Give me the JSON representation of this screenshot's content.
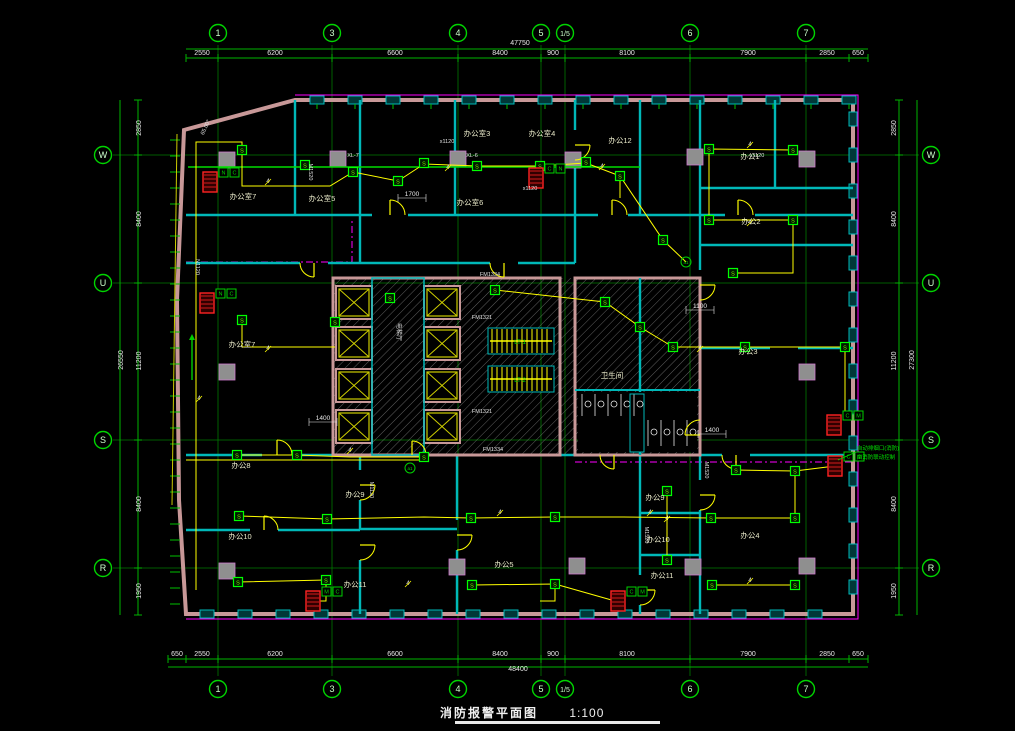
{
  "title": {
    "text": "消防报警平面图",
    "scale": "1:100"
  },
  "colors": {
    "bg": "#000000",
    "gridline": "#007a00",
    "dimline": "#00b400",
    "bubble": "#00d400",
    "bubble_text": "#ccffcc",
    "dim_text": "#e8e8e8",
    "wall_outer": "#c89898",
    "wall_inner": "#00b8b8",
    "wire": "#ffff00",
    "bus": "#00dd00",
    "detector": "#00ff00",
    "hydrant": "#ff2222",
    "magenta": "#ff00ff",
    "column": "#8f8f8f",
    "column_stroke": "#cc77cc",
    "hatch": "#8a8a8a",
    "room_label": "#e8e8c8",
    "code_label": "#e0e0e0",
    "note": "#00e000",
    "stair": "#ffff00"
  },
  "grid": {
    "cols": [
      {
        "label": "1",
        "x": 218
      },
      {
        "label": "3",
        "x": 332
      },
      {
        "label": "4",
        "x": 458
      },
      {
        "label": "5",
        "x": 541
      },
      {
        "label": "1/5",
        "x": 565
      },
      {
        "label": "6",
        "x": 690
      },
      {
        "label": "7",
        "x": 806
      }
    ],
    "rows": [
      {
        "label": "W",
        "y": 155
      },
      {
        "label": "U",
        "y": 283
      },
      {
        "label": "S",
        "y": 440
      },
      {
        "label": "R",
        "y": 568
      }
    ],
    "top_bubble_y": 33,
    "bottom_bubble_y": 689,
    "left_bubble_x": 103,
    "right_bubble_x": 931
  },
  "dims": {
    "top": {
      "total": "47750",
      "total_x": 520,
      "total_y": 45,
      "total_line_y": 49,
      "line_y": 58,
      "x0": 186,
      "x1": 868,
      "ticks": [
        186,
        218,
        332,
        458,
        541,
        565,
        690,
        806,
        849,
        868
      ],
      "values": [
        {
          "v": "2550",
          "x": 202
        },
        {
          "v": "6200",
          "x": 275
        },
        {
          "v": "6600",
          "x": 395
        },
        {
          "v": "8400",
          "x": 500
        },
        {
          "v": "900",
          "x": 553
        },
        {
          "v": "8100",
          "x": 627
        },
        {
          "v": "7900",
          "x": 748
        },
        {
          "v": "2850",
          "x": 827
        },
        {
          "v": "650",
          "x": 858
        }
      ]
    },
    "bottom": {
      "total": "48400",
      "total_x": 518,
      "total_y": 671,
      "total_line_y": 667,
      "line_y": 659,
      "x0": 168,
      "x1": 868,
      "ticks": [
        168,
        186,
        218,
        332,
        458,
        541,
        565,
        690,
        806,
        849,
        868
      ],
      "values": [
        {
          "v": "650",
          "x": 177
        },
        {
          "v": "2550",
          "x": 202
        },
        {
          "v": "6200",
          "x": 275
        },
        {
          "v": "6600",
          "x": 395
        },
        {
          "v": "8400",
          "x": 500
        },
        {
          "v": "900",
          "x": 553
        },
        {
          "v": "8100",
          "x": 627
        },
        {
          "v": "7900",
          "x": 748
        },
        {
          "v": "2850",
          "x": 827
        },
        {
          "v": "650",
          "x": 858
        }
      ]
    },
    "left": {
      "line_x": 138,
      "outer_x": 120,
      "total": "26550",
      "total_y": 360,
      "ticks": [
        100,
        155,
        283,
        440,
        568,
        615
      ],
      "values": [
        {
          "v": "2850",
          "y": 128
        },
        {
          "v": "8400",
          "y": 219
        },
        {
          "v": "11200",
          "y": 361
        },
        {
          "v": "8400",
          "y": 504
        },
        {
          "v": "1950",
          "y": 591
        }
      ]
    },
    "right": {
      "line_x": 899,
      "outer_x": 917,
      "total": "27300",
      "total_y": 360,
      "ticks": [
        100,
        155,
        283,
        440,
        568,
        615
      ],
      "values": [
        {
          "v": "2850",
          "y": 128
        },
        {
          "v": "8400",
          "y": 219
        },
        {
          "v": "11200",
          "y": 361
        },
        {
          "v": "8400",
          "y": 504
        },
        {
          "v": "1950",
          "y": 591
        }
      ]
    }
  },
  "rooms": [
    {
      "label": "办公室7",
      "x": 243,
      "y": 199
    },
    {
      "label": "办公室5",
      "x": 322,
      "y": 201
    },
    {
      "label": "办公室3",
      "x": 477,
      "y": 136
    },
    {
      "label": "办公室4",
      "x": 542,
      "y": 136
    },
    {
      "label": "办公12",
      "x": 620,
      "y": 143
    },
    {
      "label": "办公室6",
      "x": 470,
      "y": 205
    },
    {
      "label": "办公1",
      "x": 750,
      "y": 159
    },
    {
      "label": "办公2",
      "x": 751,
      "y": 224
    },
    {
      "label": "办公室7",
      "x": 242,
      "y": 347
    },
    {
      "label": "办公3",
      "x": 748,
      "y": 354
    },
    {
      "label": "办公8",
      "x": 241,
      "y": 468
    },
    {
      "label": "办公10",
      "x": 240,
      "y": 539
    },
    {
      "label": "办公9",
      "x": 355,
      "y": 497
    },
    {
      "label": "办公11",
      "x": 355,
      "y": 587
    },
    {
      "label": "办公5",
      "x": 504,
      "y": 567
    },
    {
      "label": "办公9",
      "x": 655,
      "y": 500
    },
    {
      "label": "办公10",
      "x": 658,
      "y": 542
    },
    {
      "label": "办公11",
      "x": 662,
      "y": 578
    },
    {
      "label": "办公4",
      "x": 750,
      "y": 538
    },
    {
      "label": "卫生间",
      "x": 612,
      "y": 378
    }
  ],
  "core_label": {
    "text": "电梯厅",
    "x": 397,
    "y": 332
  },
  "stair_labels": [
    {
      "text": "LT-1",
      "x": 520,
      "y": 344
    },
    {
      "text": "LT-2",
      "x": 520,
      "y": 382
    }
  ],
  "codes": [
    {
      "text": "XL-7",
      "x": 353,
      "y": 157,
      "rot": 0
    },
    {
      "text": "XL-6",
      "x": 472,
      "y": 157,
      "rot": 0
    },
    {
      "text": "FM1334",
      "x": 490,
      "y": 276,
      "rot": 0
    },
    {
      "text": "FM1321",
      "x": 482,
      "y": 319,
      "rot": 0
    },
    {
      "text": "FM1321",
      "x": 482,
      "y": 413,
      "rot": 0
    },
    {
      "text": "FM1334",
      "x": 493,
      "y": 451,
      "rot": 0
    },
    {
      "text": "M1520",
      "x": 309,
      "y": 172,
      "rot": 90
    },
    {
      "text": "x1120",
      "x": 447,
      "y": 143,
      "rot": 0
    },
    {
      "text": "x1120",
      "x": 530,
      "y": 190,
      "rot": 0
    },
    {
      "text": "x1120",
      "x": 757,
      "y": 157,
      "rot": 0
    },
    {
      "text": "N1120",
      "x": 196,
      "y": 267,
      "rot": 90
    },
    {
      "text": "M1120",
      "x": 370,
      "y": 490,
      "rot": 90
    },
    {
      "text": "M1520",
      "x": 645,
      "y": 535,
      "rot": 90
    },
    {
      "text": "M1520",
      "x": 705,
      "y": 470,
      "rot": 90
    },
    {
      "text": "65.00°",
      "x": 207,
      "y": 128,
      "rot": -65
    }
  ],
  "inner_dims": [
    {
      "v": "1700",
      "x": 412,
      "y": 196
    },
    {
      "v": "1100",
      "x": 700,
      "y": 308
    },
    {
      "v": "1400",
      "x": 323,
      "y": 420
    },
    {
      "v": "1400",
      "x": 712,
      "y": 432
    }
  ],
  "notes": [
    {
      "text": "自动排烟口(消防)",
      "x": 878,
      "y": 450
    },
    {
      "text": "由消防联动控制",
      "x": 876,
      "y": 459
    }
  ],
  "detectors": [
    [
      242,
      150
    ],
    [
      305,
      165
    ],
    [
      353,
      172
    ],
    [
      398,
      181
    ],
    [
      424,
      163
    ],
    [
      477,
      166
    ],
    [
      540,
      166
    ],
    [
      586,
      162
    ],
    [
      620,
      176
    ],
    [
      663,
      240
    ],
    [
      709,
      149
    ],
    [
      793,
      150
    ],
    [
      709,
      220
    ],
    [
      793,
      220
    ],
    [
      733,
      273
    ],
    [
      242,
      320
    ],
    [
      335,
      322
    ],
    [
      390,
      298
    ],
    [
      495,
      290
    ],
    [
      605,
      302
    ],
    [
      640,
      327
    ],
    [
      673,
      347
    ],
    [
      745,
      347
    ],
    [
      845,
      347
    ],
    [
      237,
      455
    ],
    [
      297,
      455
    ],
    [
      424,
      457
    ],
    [
      239,
      516
    ],
    [
      327,
      519
    ],
    [
      471,
      518
    ],
    [
      555,
      517
    ],
    [
      711,
      518
    ],
    [
      795,
      518
    ],
    [
      238,
      582
    ],
    [
      326,
      580
    ],
    [
      472,
      585
    ],
    [
      555,
      584
    ],
    [
      712,
      585
    ],
    [
      795,
      585
    ],
    [
      736,
      470
    ],
    [
      795,
      471
    ],
    [
      667,
      491
    ],
    [
      667,
      560
    ]
  ],
  "detector_symbol": "S",
  "circle_tags": [
    {
      "text": "a1",
      "x": 410,
      "y": 468
    },
    {
      "text": "a1",
      "x": 686,
      "y": 262
    }
  ],
  "hydrants": [
    {
      "x": 210,
      "y": 182,
      "tag": "N C"
    },
    {
      "x": 207,
      "y": 303,
      "tag": "N C"
    },
    {
      "x": 536,
      "y": 178,
      "tag": "C N"
    },
    {
      "x": 313,
      "y": 601,
      "tag": "M C"
    },
    {
      "x": 618,
      "y": 601,
      "tag": "C M"
    },
    {
      "x": 834,
      "y": 425,
      "tag": "C M"
    },
    {
      "x": 835,
      "y": 466,
      "tag": "C M"
    }
  ],
  "wire_tags": [
    "4",
    "4",
    "4",
    "4",
    "4",
    "4",
    "4",
    "4",
    "4",
    "4",
    "4",
    "4",
    "4",
    "4"
  ],
  "wire_tag_pos": [
    [
      268,
      183
    ],
    [
      448,
      169
    ],
    [
      602,
      168
    ],
    [
      750,
      146
    ],
    [
      750,
      224
    ],
    [
      268,
      350
    ],
    [
      700,
      350
    ],
    [
      350,
      452
    ],
    [
      500,
      514
    ],
    [
      650,
      514
    ],
    [
      750,
      582
    ],
    [
      408,
      585
    ],
    [
      199,
      400
    ],
    [
      667,
      520
    ]
  ],
  "columns": [
    [
      227,
      160
    ],
    [
      338,
      159
    ],
    [
      458,
      159
    ],
    [
      573,
      160
    ],
    [
      695,
      157
    ],
    [
      807,
      159
    ],
    [
      227,
      372
    ],
    [
      807,
      372
    ],
    [
      227,
      571
    ],
    [
      457,
      567
    ],
    [
      577,
      566
    ],
    [
      693,
      567
    ],
    [
      807,
      566
    ]
  ],
  "walls": {
    "outer": [
      [
        295,
        100
      ],
      [
        853,
        100
      ],
      [
        853,
        614
      ],
      [
        186,
        614
      ],
      [
        179,
        500
      ],
      [
        177,
        300
      ],
      [
        184,
        130
      ]
    ],
    "inner_h": [
      [
        186,
        215,
        372,
        215
      ],
      [
        408,
        215,
        598,
        215
      ],
      [
        628,
        215,
        725,
        215
      ],
      [
        755,
        215,
        853,
        215
      ],
      [
        186,
        263,
        300,
        263
      ],
      [
        328,
        263,
        490,
        263
      ],
      [
        518,
        263,
        575,
        263
      ],
      [
        700,
        188,
        853,
        188
      ],
      [
        700,
        245,
        853,
        245
      ],
      [
        700,
        348,
        770,
        348
      ],
      [
        798,
        348,
        853,
        348
      ],
      [
        186,
        455,
        262,
        455
      ],
      [
        292,
        455,
        333,
        455
      ],
      [
        426,
        455,
        575,
        455
      ],
      [
        628,
        455,
        722,
        455
      ],
      [
        750,
        455,
        853,
        455
      ],
      [
        186,
        530,
        250,
        530
      ],
      [
        278,
        530,
        360,
        530
      ],
      [
        640,
        513,
        700,
        513
      ],
      [
        640,
        555,
        700,
        555
      ],
      [
        360,
        529,
        457,
        529
      ]
    ],
    "inner_v": [
      [
        295,
        100,
        295,
        215
      ],
      [
        360,
        100,
        360,
        263
      ],
      [
        455,
        100,
        455,
        215
      ],
      [
        575,
        100,
        575,
        130
      ],
      [
        575,
        160,
        575,
        263
      ],
      [
        640,
        100,
        640,
        215
      ],
      [
        775,
        100,
        775,
        188
      ],
      [
        700,
        100,
        700,
        270
      ],
      [
        700,
        300,
        700,
        420
      ],
      [
        700,
        450,
        700,
        455
      ],
      [
        360,
        455,
        360,
        470
      ],
      [
        360,
        500,
        360,
        530
      ],
      [
        360,
        560,
        360,
        614
      ],
      [
        457,
        455,
        457,
        520
      ],
      [
        457,
        550,
        457,
        614
      ],
      [
        640,
        455,
        640,
        575
      ],
      [
        640,
        605,
        640,
        614
      ],
      [
        700,
        455,
        700,
        480
      ],
      [
        700,
        510,
        700,
        614
      ]
    ]
  },
  "core": {
    "band": [
      333,
      278,
      367,
      177
    ],
    "outer": [
      333,
      278,
      227,
      177
    ],
    "shaft_w": 36,
    "shaft_h": 33,
    "shaft_cols": [
      336,
      424
    ],
    "shaft_rows": [
      286,
      327,
      369,
      410
    ],
    "lobby": [
      372,
      278,
      52,
      177
    ],
    "stairs": [
      {
        "x": 488,
        "y": 328,
        "w": 66,
        "h": 26
      },
      {
        "x": 488,
        "y": 366,
        "w": 66,
        "h": 26
      }
    ],
    "wash": [
      575,
      278,
      125,
      177
    ],
    "wash_split_x": 640,
    "toilet_y": 390
  },
  "wires": [
    [
      [
        196,
        590
      ],
      [
        196,
        142
      ],
      [
        242,
        142
      ],
      [
        242,
        150
      ]
    ],
    [
      [
        242,
        150
      ],
      [
        242,
        186
      ],
      [
        330,
        186
      ],
      [
        353,
        172
      ],
      [
        398,
        181
      ],
      [
        424,
        164
      ]
    ],
    [
      [
        424,
        164
      ],
      [
        477,
        166
      ],
      [
        540,
        166
      ],
      [
        586,
        163
      ],
      [
        620,
        176
      ],
      [
        620,
        198
      ]
    ],
    [
      [
        620,
        176
      ],
      [
        663,
        240
      ],
      [
        686,
        262
      ]
    ],
    [
      [
        793,
        150
      ],
      [
        709,
        149
      ],
      [
        709,
        220
      ],
      [
        793,
        220
      ]
    ],
    [
      [
        733,
        273
      ],
      [
        793,
        273
      ],
      [
        793,
        222
      ]
    ],
    [
      [
        242,
        320
      ],
      [
        242,
        347
      ],
      [
        335,
        347
      ]
    ],
    [
      [
        495,
        290
      ],
      [
        605,
        302
      ],
      [
        640,
        327
      ],
      [
        673,
        347
      ]
    ],
    [
      [
        673,
        347
      ],
      [
        745,
        347
      ],
      [
        845,
        347
      ],
      [
        845,
        420
      ]
    ],
    [
      [
        237,
        455
      ],
      [
        297,
        455
      ],
      [
        350,
        457
      ],
      [
        424,
        457
      ]
    ],
    [
      [
        239,
        516
      ],
      [
        327,
        519
      ],
      [
        424,
        517
      ],
      [
        471,
        518
      ],
      [
        555,
        517
      ],
      [
        623,
        517
      ],
      [
        711,
        518
      ],
      [
        795,
        518
      ]
    ],
    [
      [
        795,
        518
      ],
      [
        795,
        471
      ],
      [
        736,
        470
      ]
    ],
    [
      [
        795,
        471
      ],
      [
        835,
        466
      ]
    ],
    [
      [
        238,
        582
      ],
      [
        326,
        580
      ],
      [
        326,
        601
      ],
      [
        316,
        601
      ]
    ],
    [
      [
        472,
        585
      ],
      [
        555,
        584
      ],
      [
        555,
        601
      ],
      [
        540,
        601
      ]
    ],
    [
      [
        555,
        584
      ],
      [
        615,
        601
      ]
    ],
    [
      [
        712,
        585
      ],
      [
        795,
        585
      ]
    ],
    [
      [
        667,
        491
      ],
      [
        667,
        560
      ]
    ],
    [
      [
        186,
        460
      ],
      [
        420,
        460
      ]
    ],
    [
      [
        536,
        178
      ],
      [
        536,
        167
      ]
    ]
  ],
  "bus_lines": [
    [
      [
        188,
        167
      ],
      [
        640,
        167
      ]
    ]
  ],
  "magenta_lines": [
    [
      [
        186,
        262
      ],
      [
        352,
        262
      ],
      [
        352,
        218
      ]
    ],
    [
      [
        575,
        462
      ],
      [
        853,
        462
      ]
    ],
    [
      [
        295,
        95
      ],
      [
        858,
        95
      ],
      [
        858,
        619
      ],
      [
        186,
        619
      ]
    ]
  ],
  "doors": [
    {
      "x": 390,
      "y": 215,
      "r": 15,
      "rot": 0
    },
    {
      "x": 612,
      "y": 215,
      "r": 15,
      "rot": 0
    },
    {
      "x": 738,
      "y": 215,
      "r": 15,
      "rot": 0
    },
    {
      "x": 314,
      "y": 263,
      "r": 14,
      "rot": 180
    },
    {
      "x": 504,
      "y": 263,
      "r": 14,
      "rot": 180
    },
    {
      "x": 277,
      "y": 455,
      "r": 15,
      "rot": 0
    },
    {
      "x": 412,
      "y": 455,
      "r": 14,
      "rot": 0
    },
    {
      "x": 614,
      "y": 455,
      "r": 14,
      "rot": 180
    },
    {
      "x": 736,
      "y": 455,
      "r": 14,
      "rot": 180
    },
    {
      "x": 264,
      "y": 530,
      "r": 14,
      "rot": 0
    },
    {
      "x": 360,
      "y": 485,
      "r": 15,
      "rot": 90
    },
    {
      "x": 360,
      "y": 545,
      "r": 15,
      "rot": 90
    },
    {
      "x": 457,
      "y": 535,
      "r": 15,
      "rot": 90
    },
    {
      "x": 640,
      "y": 590,
      "r": 15,
      "rot": 90
    },
    {
      "x": 700,
      "y": 285,
      "r": 15,
      "rot": 90
    },
    {
      "x": 700,
      "y": 435,
      "r": 15,
      "rot": 270
    },
    {
      "x": 700,
      "y": 495,
      "r": 15,
      "rot": 90
    },
    {
      "x": 575,
      "y": 145,
      "r": 15,
      "rot": 90
    }
  ],
  "arrow": {
    "x": 192,
    "y1": 380,
    "y2": 340
  }
}
